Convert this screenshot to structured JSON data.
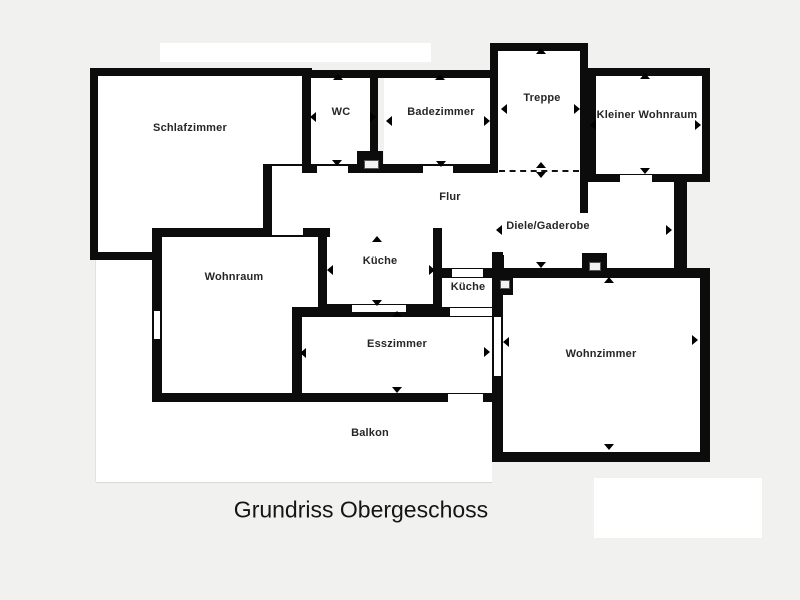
{
  "title": "Grundriss Obergeschoss",
  "rooms": {
    "schlafzimmer": "Schlafzimmer",
    "wc": "WC",
    "badezimmer": "Badezimmer",
    "treppe": "Treppe",
    "kleiner_wohnraum": "Kleiner Wohnraum",
    "flur": "Flur",
    "diele": "Diele/Gaderobe",
    "wohnraum": "Wohnraum",
    "kueche_gross": "Küche",
    "kueche_klein": "Küche",
    "esszimmer": "Esszimmer",
    "wohnzimmer": "Wohnzimmer",
    "balkon": "Balkon"
  },
  "colors": {
    "background": "#f1f1f0",
    "wall": "#0c0c0c",
    "floor": "#ffffff",
    "text": "#262626"
  }
}
